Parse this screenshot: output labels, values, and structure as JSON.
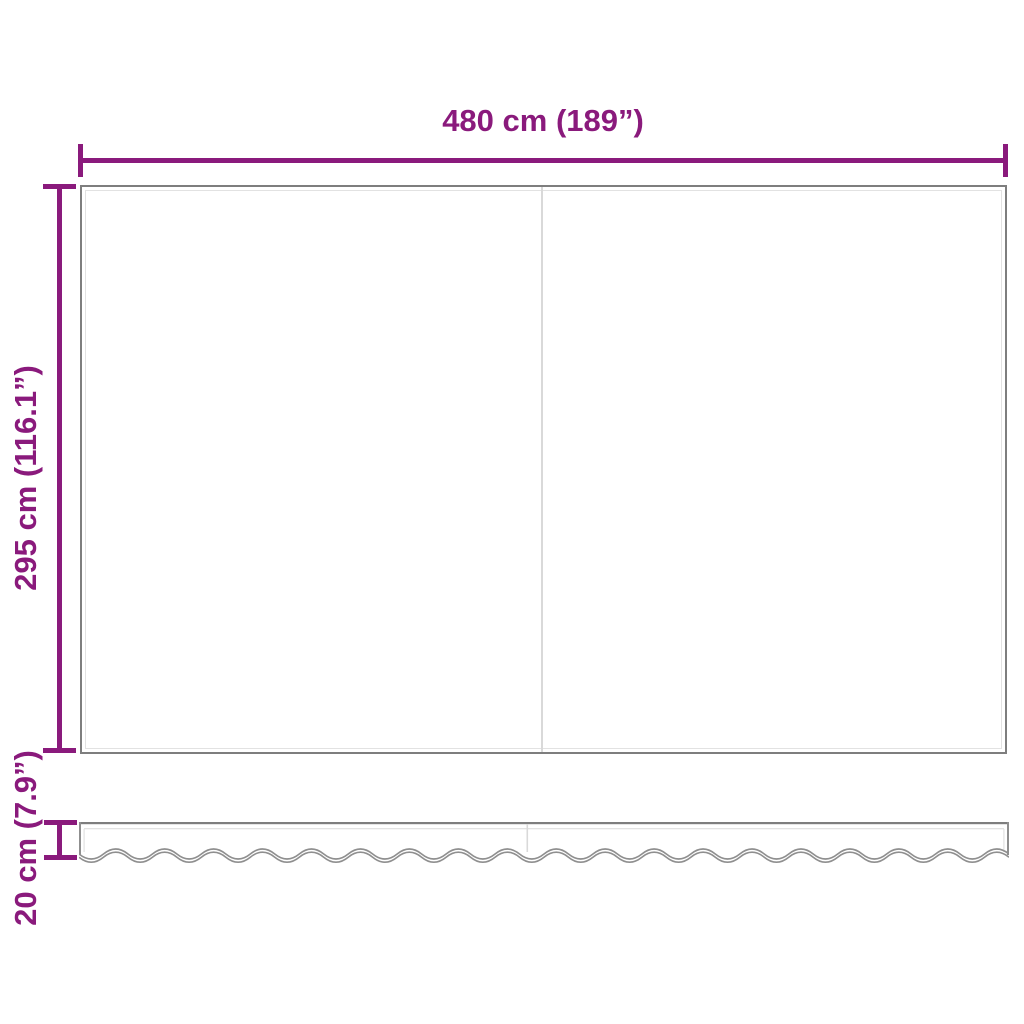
{
  "diagram": {
    "title": "awning-fabric-dimension-diagram",
    "accent_color": "#8A1A7C",
    "outline_color": "#7E7E7E",
    "dimensions": {
      "width": {
        "label": "480 cm (189”)",
        "value_cm": 480,
        "value_inch": 189
      },
      "height": {
        "label": "295 cm (116.1”)",
        "value_cm": 295,
        "value_inch": 116.1
      },
      "valance_height": {
        "label": "20 cm (7.9”)",
        "value_cm": 20,
        "value_inch": 7.9
      }
    }
  }
}
